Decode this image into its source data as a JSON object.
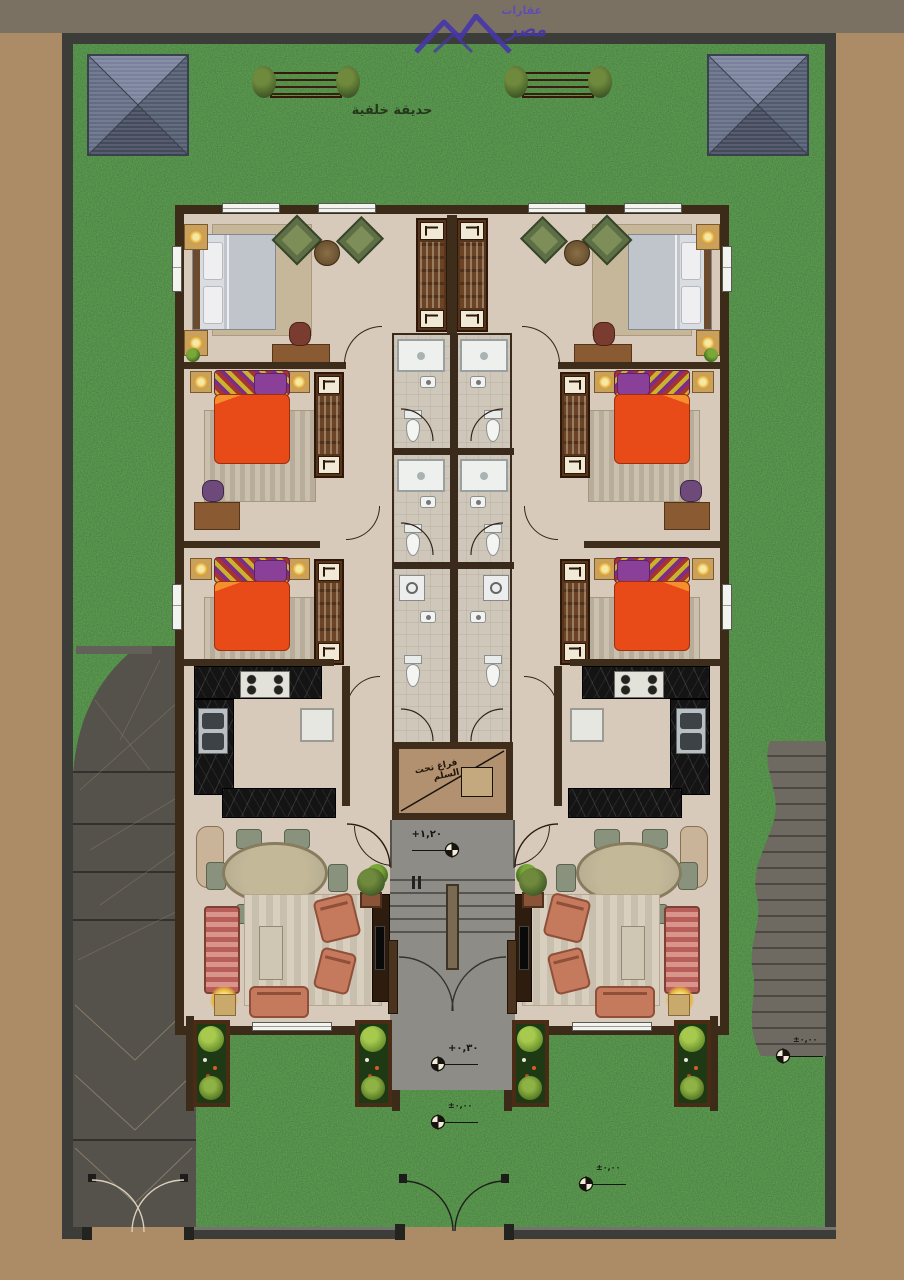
{
  "labels": {
    "back_garden": "حديقة خلفية",
    "under_stair_void": "فراغ تحت السلم"
  },
  "logo": {
    "word_top": "عقارات",
    "word_main": "مصر"
  },
  "level_markers": [
    {
      "location": "entry-landing",
      "value": "+١,٢٠"
    },
    {
      "location": "entry-porch",
      "value": "+٠,٣٠"
    },
    {
      "location": "front-walk",
      "value": "±٠,٠٠"
    },
    {
      "location": "front-garden",
      "value": "±٠,٠٠"
    },
    {
      "location": "side-garden",
      "value": "±٠,٠٠"
    }
  ],
  "colors": {
    "ground_tan": "#ab8c66",
    "top_band_gray": "#7b7163",
    "grass_green": "#2b5526",
    "boundary_wall": "#3c3c38",
    "driveway_gray": "#55514b",
    "side_path_gray": "#6e6a62",
    "building_wall_brown": "#3d2b1a",
    "floor_beige": "#d8cabb",
    "kitchen_marble_black": "#141414",
    "bed_orange": "#e84a18",
    "pillow_purple": "#8a4099",
    "bed_gray": "#c6cad1",
    "sofa_terracotta": "#c57a5e",
    "stair_gray": "#8e8c86",
    "void_panel_tan": "#b29170",
    "roof_blue_gray": "#5d6574",
    "logo_purple": "#4636aa",
    "bench_wood": "#6a3a22"
  }
}
